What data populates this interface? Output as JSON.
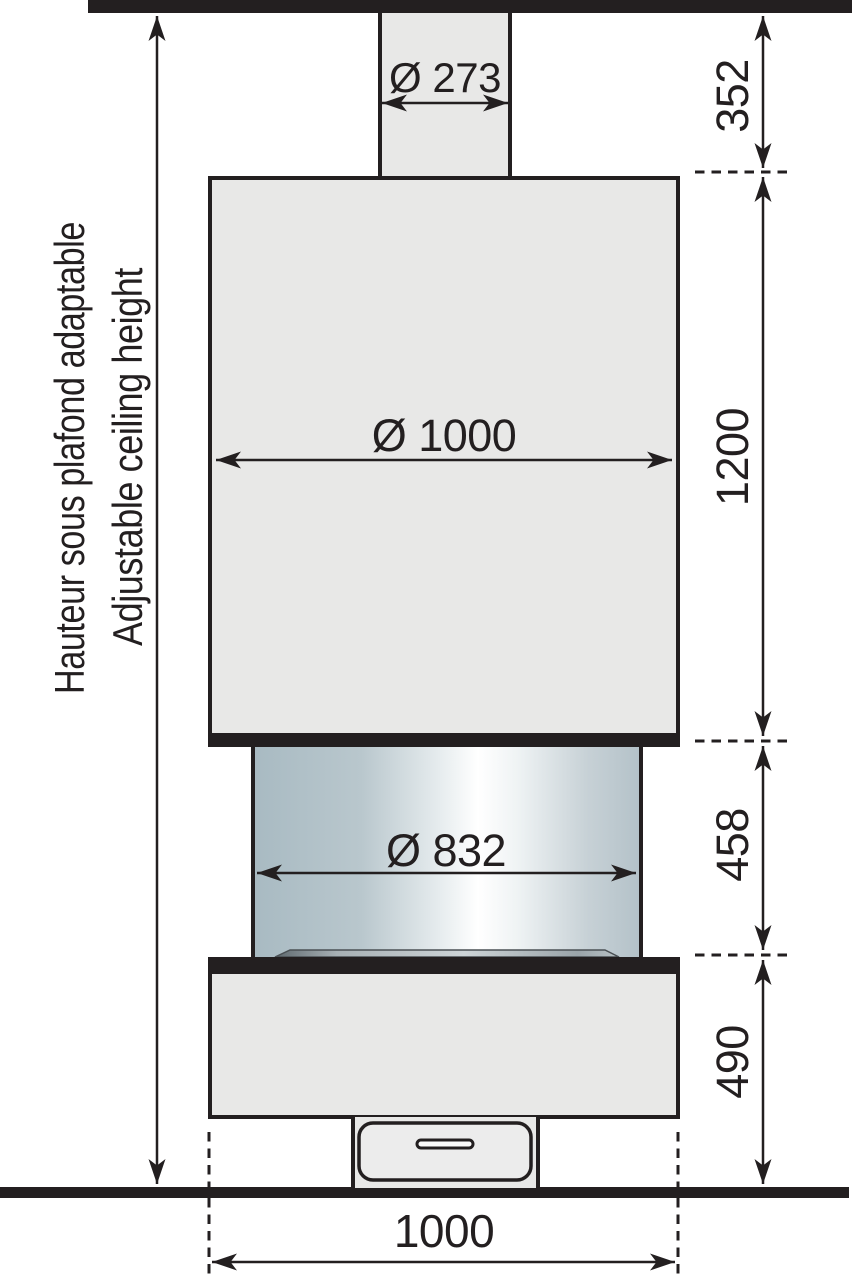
{
  "labels": {
    "adjustable_height_fr": "Hauteur sous plafond adaptable",
    "adjustable_height_en": "Adjustable ceiling height",
    "flue_diameter": "Ø 273",
    "hood_diameter": "Ø 1000",
    "firebox_diameter": "Ø 832",
    "base_width": "1000",
    "flue_height": "352",
    "hood_height": "1200",
    "firebox_height": "458",
    "base_height": "490"
  },
  "colors": {
    "ink": "#231f20",
    "panel_fill": "#e8e8e7",
    "drawer_fill": "#ececec",
    "glass_edge_left": "#a8bac2",
    "glass_highlight": "#ffffff",
    "glass_edge_right": "#b3c1c8"
  }
}
